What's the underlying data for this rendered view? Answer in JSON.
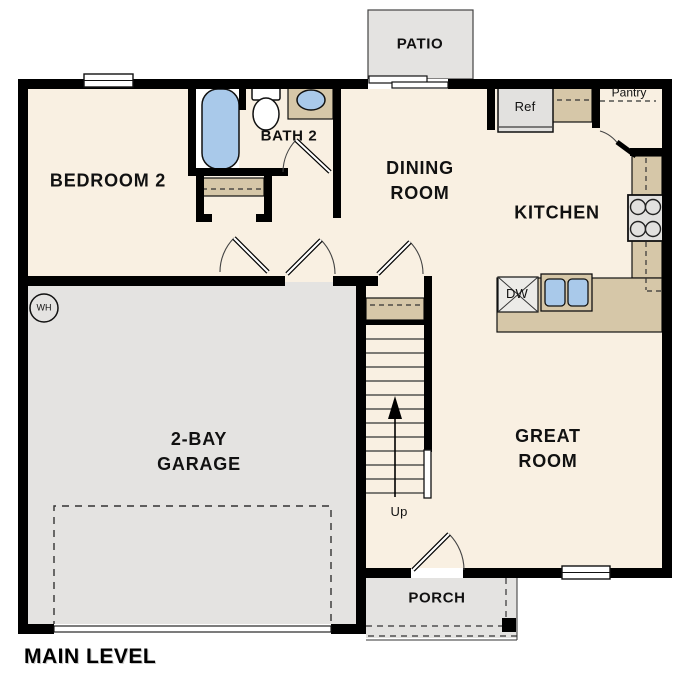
{
  "title": {
    "label": "MAIN LEVEL"
  },
  "rooms": {
    "patio": {
      "label": "PATIO"
    },
    "bedroom2": {
      "label": "BEDROOM 2"
    },
    "bath2": {
      "label": "BATH 2"
    },
    "dining": {
      "line1": "DINING",
      "line2": "ROOM"
    },
    "kitchen": {
      "label": "KITCHEN"
    },
    "great_room": {
      "line1": "GREAT",
      "line2": "ROOM"
    },
    "garage": {
      "line1": "2-BAY",
      "line2": "GARAGE"
    },
    "porch": {
      "label": "PORCH"
    }
  },
  "fixtures": {
    "refrigerator": "Ref",
    "pantry": "Pantry",
    "dishwasher": "DW",
    "water_heater": "WH",
    "stairs_direction": "Up"
  },
  "colors": {
    "wall": "#000000",
    "floor": "#f9f0e2",
    "concrete": "#e4e3e1",
    "counter": "#d6c7a8",
    "fixture_blue": "#a9c9ea"
  }
}
